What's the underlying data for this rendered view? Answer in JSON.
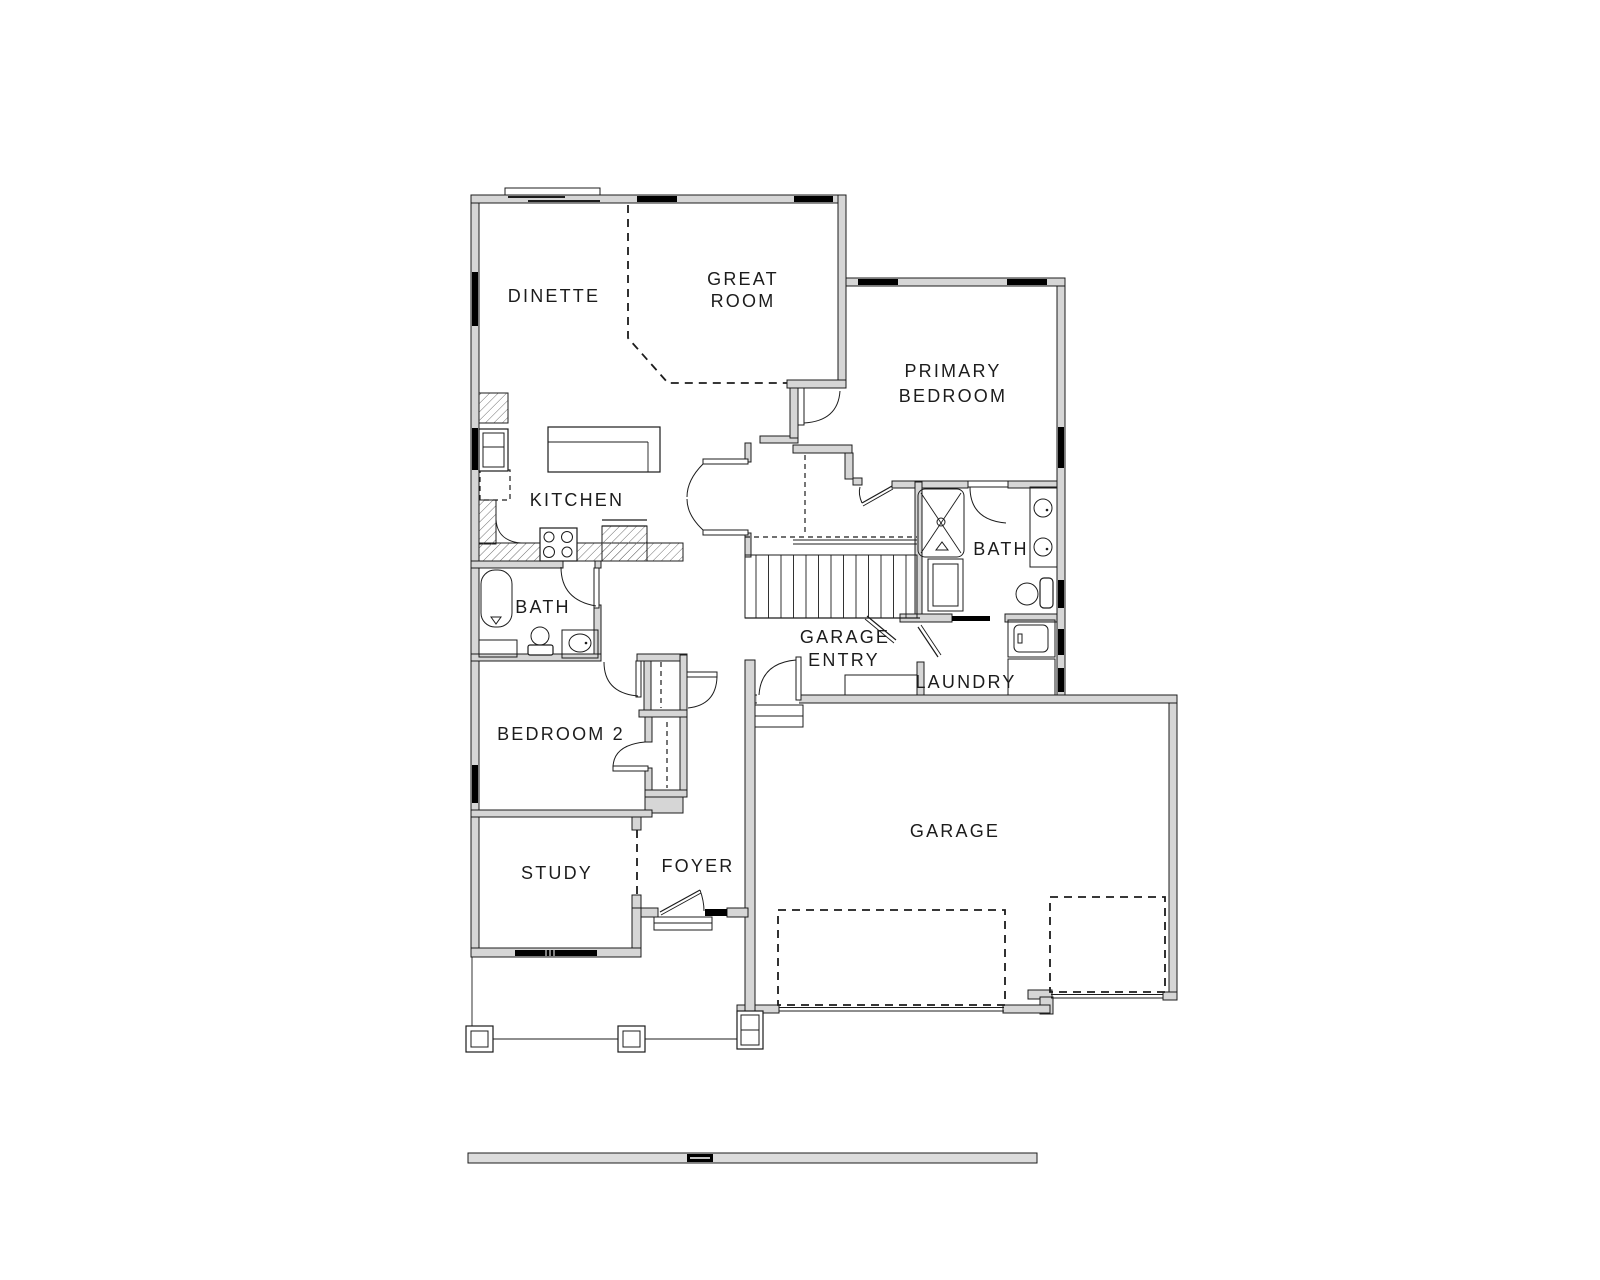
{
  "document": {
    "type": "architectural-floor-plan",
    "level": "main-floor"
  },
  "colors": {
    "background": "#ffffff",
    "wall_fill": "#d6d6d6",
    "line": "#1c1c1c",
    "window": "#000000",
    "site_strip_fill": "#dcdcdc"
  },
  "rooms": {
    "dinette": "DINETTE",
    "great_room_line1": "GREAT",
    "great_room_line2": "ROOM",
    "primary_bedroom_line1": "PRIMARY",
    "primary_bedroom_line2": "BEDROOM",
    "kitchen": "KITCHEN",
    "hall_bath": "BATH",
    "primary_bath": "BATH",
    "bedroom2": "BEDROOM 2",
    "study": "STUDY",
    "foyer": "FOYER",
    "garage_entry_line1": "GARAGE",
    "garage_entry_line2": "ENTRY",
    "laundry": "LAUNDRY",
    "garage": "GARAGE"
  },
  "symbols": [
    "refrigerator",
    "kitchen-island",
    "range-cooktop",
    "counter-hatch",
    "pantry-dashed",
    "bathtub",
    "toilet",
    "sink-vanity",
    "shower-stall",
    "double-vanity",
    "washer",
    "dryer",
    "stairs",
    "bench",
    "door-swing",
    "window",
    "porch-column",
    "garage-door-dashed",
    "site-line"
  ]
}
